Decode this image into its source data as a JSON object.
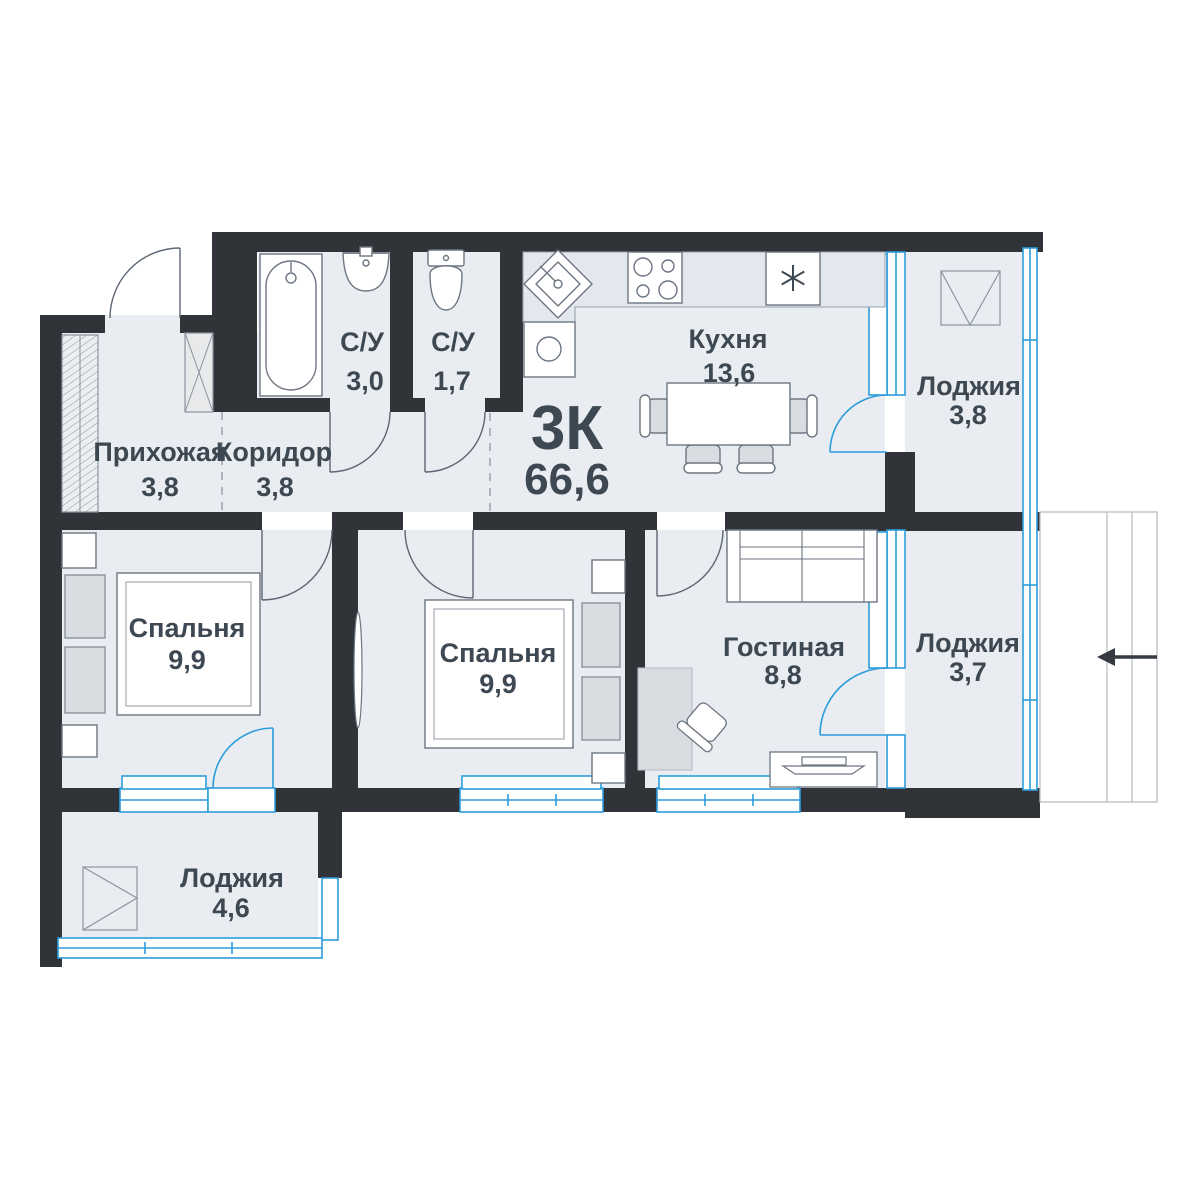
{
  "plan": {
    "type_label": "3К",
    "total_area": "66,6",
    "rooms": [
      {
        "id": "hallway",
        "label": "Прихожая",
        "area": "3,8"
      },
      {
        "id": "corridor",
        "label": "Коридор",
        "area": "3,8"
      },
      {
        "id": "bathroom",
        "label": "С/У",
        "area": "3,0"
      },
      {
        "id": "wc",
        "label": "С/У",
        "area": "1,7"
      },
      {
        "id": "kitchen",
        "label": "Кухня",
        "area": "13,6"
      },
      {
        "id": "loggia-top",
        "label": "Лоджия",
        "area": "3,8"
      },
      {
        "id": "bedroom-1",
        "label": "Спальня",
        "area": "9,9"
      },
      {
        "id": "bedroom-2",
        "label": "Спальня",
        "area": "9,9"
      },
      {
        "id": "living-room",
        "label": "Гостиная",
        "area": "8,8"
      },
      {
        "id": "loggia-right",
        "label": "Лоджия",
        "area": "3,7"
      },
      {
        "id": "loggia-bottom",
        "label": "Лоджия",
        "area": "4,6"
      }
    ],
    "colors": {
      "wall": "#303338",
      "floor": "#e9edf2",
      "glazing_blue": "#2d9cdb",
      "furniture_gray": "#d9dce1",
      "text": "#3e4852"
    }
  }
}
